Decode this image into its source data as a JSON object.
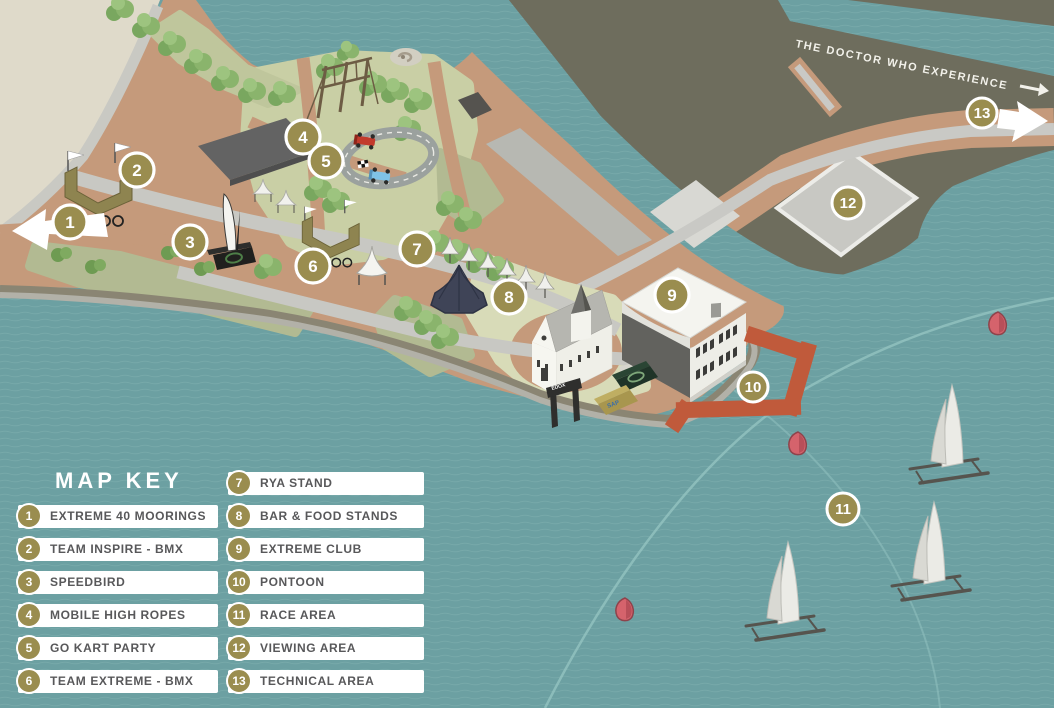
{
  "map_key": {
    "title": "MAP KEY",
    "items": [
      {
        "number": "1",
        "label": "EXTREME 40 MOORINGS"
      },
      {
        "number": "2",
        "label": "TEAM INSPIRE - BMX"
      },
      {
        "number": "3",
        "label": "SPEEDBIRD"
      },
      {
        "number": "4",
        "label": "MOBILE HIGH ROPES"
      },
      {
        "number": "5",
        "label": "GO KART PARTY"
      },
      {
        "number": "6",
        "label": "TEAM EXTREME - BMX"
      },
      {
        "number": "7",
        "label": "RYA STAND"
      },
      {
        "number": "8",
        "label": "BAR & FOOD STANDS"
      },
      {
        "number": "9",
        "label": "EXTREME CLUB"
      },
      {
        "number": "10",
        "label": "PONTOON"
      },
      {
        "number": "11",
        "label": "RACE AREA"
      },
      {
        "number": "12",
        "label": "VIEWING AREA"
      },
      {
        "number": "13",
        "label": "TECHNICAL AREA"
      }
    ]
  },
  "markers": [
    {
      "number": "1",
      "x": 70,
      "y": 222
    },
    {
      "number": "2",
      "x": 137,
      "y": 170
    },
    {
      "number": "3",
      "x": 190,
      "y": 242
    },
    {
      "number": "4",
      "x": 303,
      "y": 137
    },
    {
      "number": "5",
      "x": 326,
      "y": 161
    },
    {
      "number": "6",
      "x": 313,
      "y": 266
    },
    {
      "number": "7",
      "x": 417,
      "y": 249
    },
    {
      "number": "8",
      "x": 509,
      "y": 297
    },
    {
      "number": "9",
      "x": 672,
      "y": 295
    },
    {
      "number": "10",
      "x": 753,
      "y": 387
    },
    {
      "number": "11",
      "x": 843,
      "y": 509
    },
    {
      "number": "12",
      "x": 848,
      "y": 203
    },
    {
      "number": "13",
      "x": 982,
      "y": 113
    }
  ],
  "signage": {
    "doctor_who_label": "THE DOCTOR WHO EXPERIENCE",
    "arch_label": "EDOX",
    "container_label": "SAP"
  },
  "colors": {
    "water": "#6CA0A2",
    "land_tan": "#C59A7B",
    "land_beige": "#DFDACA",
    "land_dark": "#6E6D5D",
    "grass_light": "#C9CFA5",
    "grass_mid": "#B2BA92",
    "road_gray": "#C8C8C3",
    "pontoon_orange": "#C05A3B",
    "marker_gold": "#9A8D4F",
    "key_text": "#58585A"
  }
}
